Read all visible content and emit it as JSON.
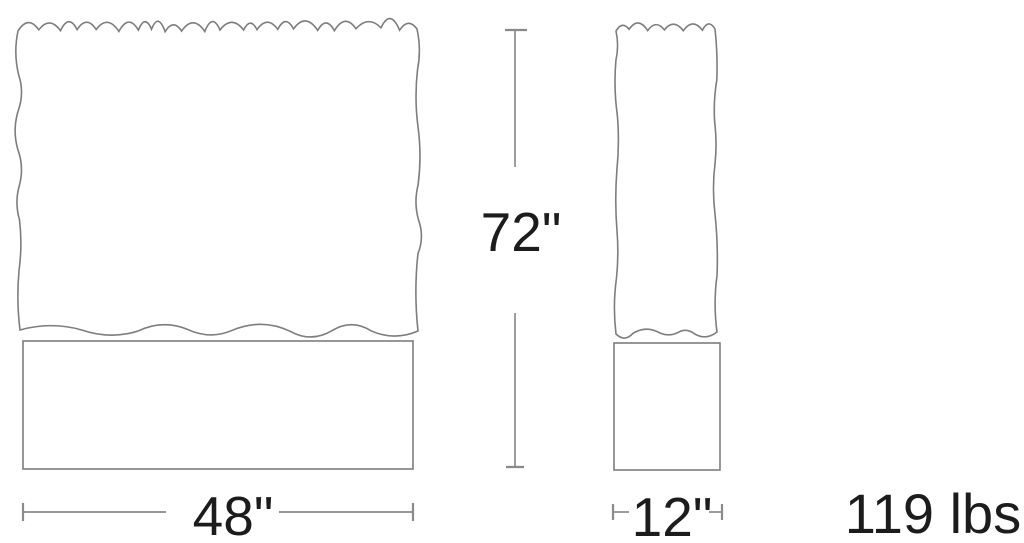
{
  "diagram": {
    "dimensions": {
      "height": "72\"",
      "width": "48\"",
      "depth": "12\"",
      "weight": "119 lbs"
    },
    "colors": {
      "outline": "#7d7d7d",
      "dimension_line": "#8a8a8a",
      "text": "#1c1c1c",
      "background": "#ffffff"
    }
  }
}
